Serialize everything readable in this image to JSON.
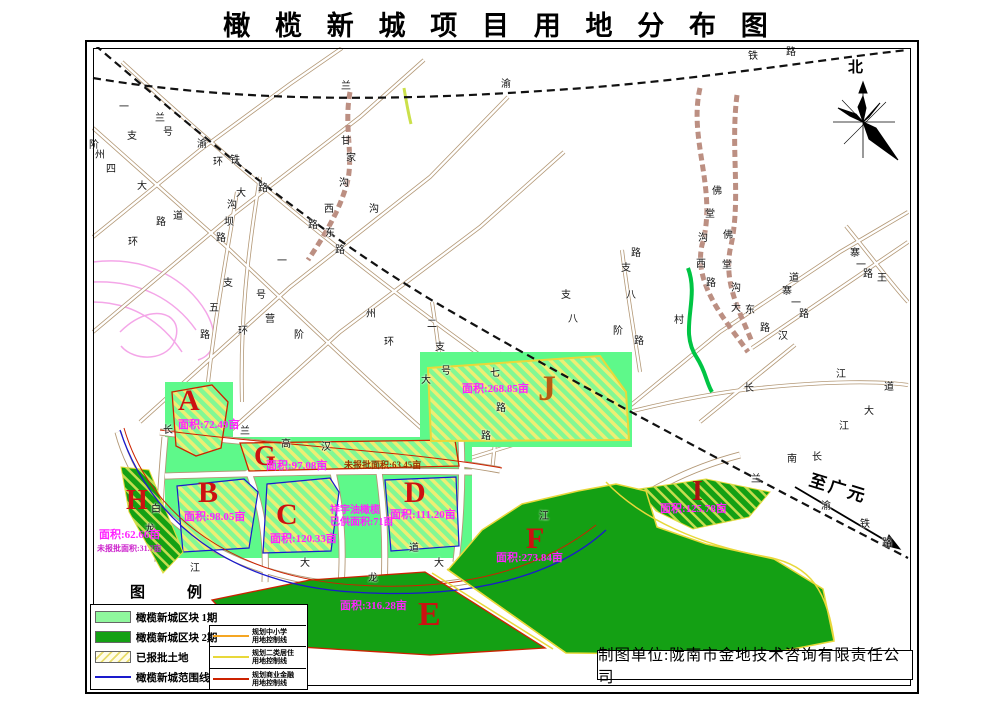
{
  "title": "橄 榄 新 城 项 目 用 地 分 布 图",
  "north_label": "北",
  "to_guangyuan": "至广元",
  "attribution": "制图单位:陇南市金地技术咨询有限责任公司",
  "colors": {
    "phase1_green": "#5ef98a",
    "phase2_green": "#14a014",
    "hatch_yellow": "#edee74",
    "zone_letter_red": "#cc1111",
    "zone_letter_orange": "#b85c12",
    "area_label_magenta": "#ff22ff",
    "boundary_blue": "#1a1acc",
    "commercial_red": "#cc2200",
    "residential_yellow": "#e8d83a",
    "school_orange": "#f5a623",
    "railway_black": "#111111",
    "road_tan": "#b39876"
  },
  "legend": {
    "title": "图　　例",
    "items_left": [
      {
        "swatch": "phase1-fill",
        "label": "橄榄新城区块 1期"
      },
      {
        "swatch": "phase2-fill",
        "label": "橄榄新城区块 2期"
      },
      {
        "swatch": "approved-hatch",
        "label": "已报批土地"
      },
      {
        "swatch": "boundary-line",
        "label": "橄榄新城范围线"
      }
    ],
    "items_right": [
      {
        "swatch": "school-line",
        "label1": "规划中小学",
        "label2": "用地控制线"
      },
      {
        "swatch": "residential-line",
        "label1": "规划二类居住",
        "label2": "用地控制线"
      },
      {
        "swatch": "commercial-line",
        "label1": "规划商业金融",
        "label2": "用地控制线"
      }
    ]
  },
  "zones": [
    {
      "id": "A",
      "letter": "A",
      "lx": 178,
      "ly": 386,
      "ls": 30,
      "lc": "#cc1111",
      "area": "面积:72.49亩",
      "ax": 178,
      "ay": 420
    },
    {
      "id": "B",
      "letter": "B",
      "lx": 198,
      "ly": 478,
      "ls": 30,
      "lc": "#cc1111",
      "area": "面积:98.05亩",
      "ax": 184,
      "ay": 512
    },
    {
      "id": "C",
      "letter": "C",
      "lx": 276,
      "ly": 500,
      "ls": 30,
      "lc": "#cc1111",
      "area": "面积:120.33亩",
      "ax": 270,
      "ay": 534
    },
    {
      "id": "D",
      "letter": "D",
      "lx": 404,
      "ly": 478,
      "ls": 30,
      "lc": "#cc1111",
      "area": "面积:111.20亩",
      "ax": 390,
      "ay": 510
    },
    {
      "id": "E",
      "letter": "E",
      "lx": 418,
      "ly": 598,
      "ls": 34,
      "lc": "#cc1111",
      "area": "面积:316.28亩",
      "ax": 340,
      "ay": 601
    },
    {
      "id": "F",
      "letter": "F",
      "lx": 526,
      "ly": 524,
      "ls": 30,
      "lc": "#cc1111",
      "area": "面积:273.84亩",
      "ax": 496,
      "ay": 553
    },
    {
      "id": "G",
      "letter": "G",
      "lx": 254,
      "ly": 443,
      "ls": 28,
      "lc": "#cc1111",
      "area": "面积:97.08亩",
      "ax": 266,
      "ay": 461
    },
    {
      "id": "H",
      "letter": "H",
      "lx": 126,
      "ly": 487,
      "ls": 28,
      "lc": "#cc1111",
      "area": "面积:62.66亩",
      "ax": 99,
      "ay": 530
    },
    {
      "id": "I",
      "letter": "I",
      "lx": 692,
      "ly": 478,
      "ls": 28,
      "lc": "#aa1111",
      "area": "面积:125.78亩",
      "ax": 660,
      "ay": 504
    },
    {
      "id": "J",
      "letter": "J",
      "lx": 538,
      "ly": 370,
      "ls": 36,
      "lc": "#b85c12",
      "area": "面积:268.85亩",
      "ax": 462,
      "ay": 384
    }
  ],
  "notes": [
    {
      "text": "未报批面积:63.45亩",
      "x": 344,
      "y": 461,
      "color": "#993300",
      "size": 9
    },
    {
      "text": "祥宇油橄榄",
      "x": 330,
      "y": 506,
      "color": "#ff22ff",
      "size": 10
    },
    {
      "text": "已供面积:71亩",
      "x": 330,
      "y": 518,
      "color": "#ff22ff",
      "size": 10
    },
    {
      "text": "未报批面积:31.7亩",
      "x": 97,
      "y": 545,
      "color": "#cc22cc",
      "size": 8
    }
  ],
  "road_labels": [
    {
      "t": "兰",
      "x": 341,
      "y": 82
    },
    {
      "t": "渝",
      "x": 501,
      "y": 80
    },
    {
      "t": "铁",
      "x": 748,
      "y": 52
    },
    {
      "t": "路",
      "x": 786,
      "y": 48
    },
    {
      "t": "一",
      "x": 119,
      "y": 103
    },
    {
      "t": "支",
      "x": 127,
      "y": 132
    },
    {
      "t": "兰",
      "x": 155,
      "y": 114
    },
    {
      "t": "号",
      "x": 163,
      "y": 128
    },
    {
      "t": "渝",
      "x": 197,
      "y": 140
    },
    {
      "t": "环",
      "x": 213,
      "y": 158
    },
    {
      "t": "铁",
      "x": 230,
      "y": 156
    },
    {
      "t": "路",
      "x": 258,
      "y": 184
    },
    {
      "t": "阶",
      "x": 89,
      "y": 141
    },
    {
      "t": "州",
      "x": 95,
      "y": 151
    },
    {
      "t": "四",
      "x": 106,
      "y": 165
    },
    {
      "t": "大",
      "x": 137,
      "y": 182
    },
    {
      "t": "路",
      "x": 156,
      "y": 218
    },
    {
      "t": "道",
      "x": 173,
      "y": 212
    },
    {
      "t": "环",
      "x": 128,
      "y": 238
    },
    {
      "t": "大",
      "x": 236,
      "y": 189
    },
    {
      "t": "沟",
      "x": 227,
      "y": 201
    },
    {
      "t": "坝",
      "x": 224,
      "y": 218
    },
    {
      "t": "路",
      "x": 216,
      "y": 234
    },
    {
      "t": "支",
      "x": 223,
      "y": 279
    },
    {
      "t": "五",
      "x": 209,
      "y": 304
    },
    {
      "t": "路",
      "x": 200,
      "y": 331
    },
    {
      "t": "一",
      "x": 277,
      "y": 257
    },
    {
      "t": "号",
      "x": 256,
      "y": 291
    },
    {
      "t": "营",
      "x": 265,
      "y": 315
    },
    {
      "t": "环",
      "x": 238,
      "y": 327
    },
    {
      "t": "阶",
      "x": 294,
      "y": 331
    },
    {
      "t": "甘",
      "x": 341,
      "y": 137
    },
    {
      "t": "家",
      "x": 346,
      "y": 154
    },
    {
      "t": "沟",
      "x": 339,
      "y": 179
    },
    {
      "t": "西",
      "x": 324,
      "y": 205
    },
    {
      "t": "路",
      "x": 308,
      "y": 221
    },
    {
      "t": "东",
      "x": 325,
      "y": 229
    },
    {
      "t": "路",
      "x": 335,
      "y": 246
    },
    {
      "t": "沟",
      "x": 369,
      "y": 205
    },
    {
      "t": "州",
      "x": 366,
      "y": 310
    },
    {
      "t": "环",
      "x": 384,
      "y": 338
    },
    {
      "t": "二",
      "x": 427,
      "y": 320
    },
    {
      "t": "支",
      "x": 435,
      "y": 343
    },
    {
      "t": "号",
      "x": 441,
      "y": 367
    },
    {
      "t": "大",
      "x": 421,
      "y": 376
    },
    {
      "t": "七",
      "x": 490,
      "y": 369
    },
    {
      "t": "路",
      "x": 496,
      "y": 404
    },
    {
      "t": "路",
      "x": 481,
      "y": 432
    },
    {
      "t": "支",
      "x": 561,
      "y": 291
    },
    {
      "t": "八",
      "x": 568,
      "y": 315
    },
    {
      "t": "路",
      "x": 631,
      "y": 249
    },
    {
      "t": "支",
      "x": 621,
      "y": 264
    },
    {
      "t": "八",
      "x": 626,
      "y": 291
    },
    {
      "t": "阶",
      "x": 613,
      "y": 327
    },
    {
      "t": "路",
      "x": 634,
      "y": 337
    },
    {
      "t": "村",
      "x": 674,
      "y": 316
    },
    {
      "t": "佛",
      "x": 712,
      "y": 187
    },
    {
      "t": "堂",
      "x": 705,
      "y": 210
    },
    {
      "t": "沟",
      "x": 698,
      "y": 234
    },
    {
      "t": "西",
      "x": 696,
      "y": 260
    },
    {
      "t": "路",
      "x": 706,
      "y": 279
    },
    {
      "t": "佛",
      "x": 723,
      "y": 231
    },
    {
      "t": "堂",
      "x": 722,
      "y": 261
    },
    {
      "t": "沟",
      "x": 731,
      "y": 284
    },
    {
      "t": "大",
      "x": 731,
      "y": 304
    },
    {
      "t": "东",
      "x": 745,
      "y": 306
    },
    {
      "t": "路",
      "x": 760,
      "y": 324
    },
    {
      "t": "汉",
      "x": 778,
      "y": 332
    },
    {
      "t": "道",
      "x": 789,
      "y": 274
    },
    {
      "t": "寨",
      "x": 850,
      "y": 249
    },
    {
      "t": "一",
      "x": 856,
      "y": 261
    },
    {
      "t": "路",
      "x": 863,
      "y": 270
    },
    {
      "t": "寨",
      "x": 782,
      "y": 287
    },
    {
      "t": "一",
      "x": 791,
      "y": 299
    },
    {
      "t": "路",
      "x": 799,
      "y": 310
    },
    {
      "t": "王",
      "x": 877,
      "y": 274
    },
    {
      "t": "长",
      "x": 744,
      "y": 384
    },
    {
      "t": "江",
      "x": 836,
      "y": 370
    },
    {
      "t": "道",
      "x": 884,
      "y": 383
    },
    {
      "t": "大",
      "x": 864,
      "y": 407
    },
    {
      "t": "江",
      "x": 839,
      "y": 422
    },
    {
      "t": "南",
      "x": 787,
      "y": 455
    },
    {
      "t": "长",
      "x": 812,
      "y": 453
    },
    {
      "t": "兰",
      "x": 751,
      "y": 475
    },
    {
      "t": "渝",
      "x": 821,
      "y": 502
    },
    {
      "t": "铁",
      "x": 860,
      "y": 520
    },
    {
      "t": "路",
      "x": 882,
      "y": 539
    },
    {
      "t": "江",
      "x": 539,
      "y": 512
    },
    {
      "t": "道",
      "x": 409,
      "y": 544
    },
    {
      "t": "大",
      "x": 434,
      "y": 559
    },
    {
      "t": "龙",
      "x": 368,
      "y": 574
    },
    {
      "t": "大",
      "x": 300,
      "y": 559
    },
    {
      "t": "白",
      "x": 151,
      "y": 505
    },
    {
      "t": "龙",
      "x": 145,
      "y": 525
    },
    {
      "t": "江",
      "x": 190,
      "y": 564
    },
    {
      "t": "长",
      "x": 163,
      "y": 426
    },
    {
      "t": "兰",
      "x": 240,
      "y": 427
    },
    {
      "t": "高",
      "x": 281,
      "y": 440
    },
    {
      "t": "汉",
      "x": 321,
      "y": 443
    }
  ]
}
